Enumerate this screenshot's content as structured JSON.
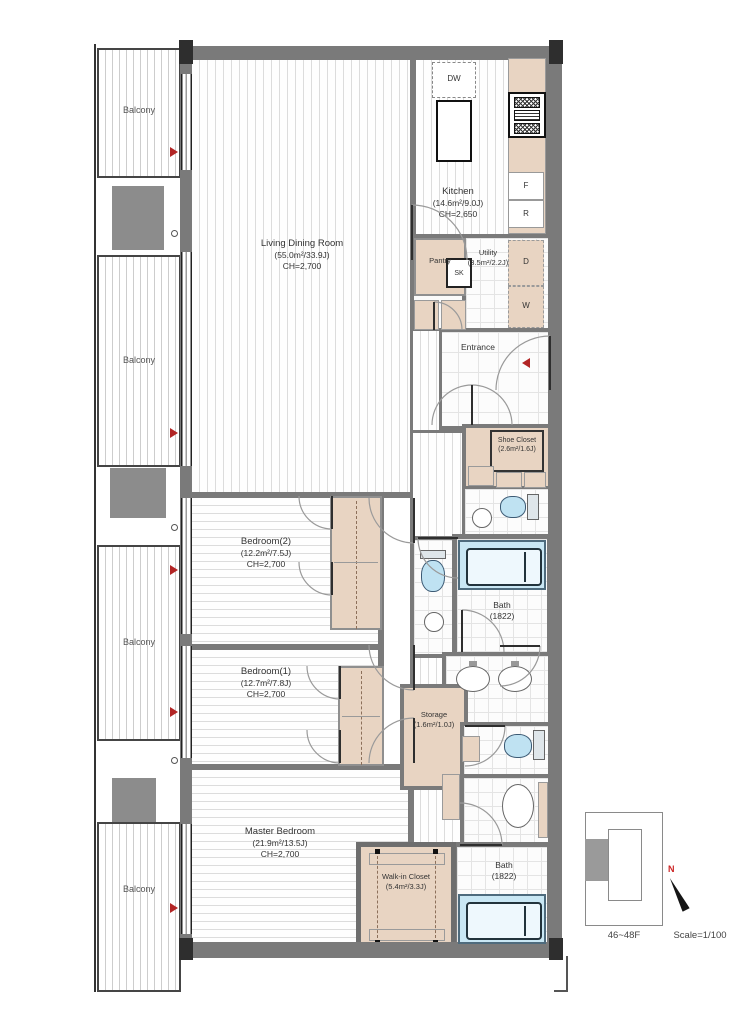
{
  "rooms": {
    "living": {
      "name": "Living Dining Room",
      "area": "(55.0m²/33.9J)",
      "ceiling": "CH=2,700"
    },
    "kitchen": {
      "name": "Kitchen",
      "area": "(14.6m²/9.0J)",
      "ceiling": "CH=2,650"
    },
    "pantry": {
      "name": "Pantry"
    },
    "utility": {
      "name": "Utility",
      "area": "(3.5m²/2.2J)"
    },
    "entrance": {
      "name": "Entrance"
    },
    "shoe_closet": {
      "name": "Shoe Closet",
      "area": "(2.6m²/1.6J)"
    },
    "bedroom2": {
      "name": "Bedroom(2)",
      "area": "(12.2m²/7.5J)",
      "ceiling": "CH=2,700"
    },
    "bedroom1": {
      "name": "Bedroom(1)",
      "area": "(12.7m²/7.8J)",
      "ceiling": "CH=2,700"
    },
    "bath_upper": {
      "name": "Bath",
      "size": "(1822)"
    },
    "bath_lower": {
      "name": "Bath",
      "size": "(1822)"
    },
    "storage": {
      "name": "Storage",
      "area": "(1.6m²/1.0J)"
    },
    "master_bedroom": {
      "name": "Master Bedroom",
      "area": "(21.9m²/13.5J)",
      "ceiling": "CH=2,700"
    },
    "walkin_closet": {
      "name": "Walk-in Closet",
      "area": "(5.4m²/3.3J)"
    }
  },
  "balconies": [
    {
      "label": "Balcony"
    },
    {
      "label": "Balcony"
    },
    {
      "label": "Balcony"
    },
    {
      "label": "Balcony"
    }
  ],
  "appliances": {
    "dishwasher": "DW",
    "sink": "SK",
    "freezer": "F",
    "refrigerator": "R",
    "dryer": "D",
    "washer": "W"
  },
  "legend": {
    "floors": "46~48F",
    "scale": "Scale=1/100",
    "north": "N"
  },
  "colors": {
    "wall": "#7a7a7a",
    "closet_fill": "#e8d4c2",
    "bath_water": "#c9e7f4",
    "accent_red": "#b22525"
  }
}
